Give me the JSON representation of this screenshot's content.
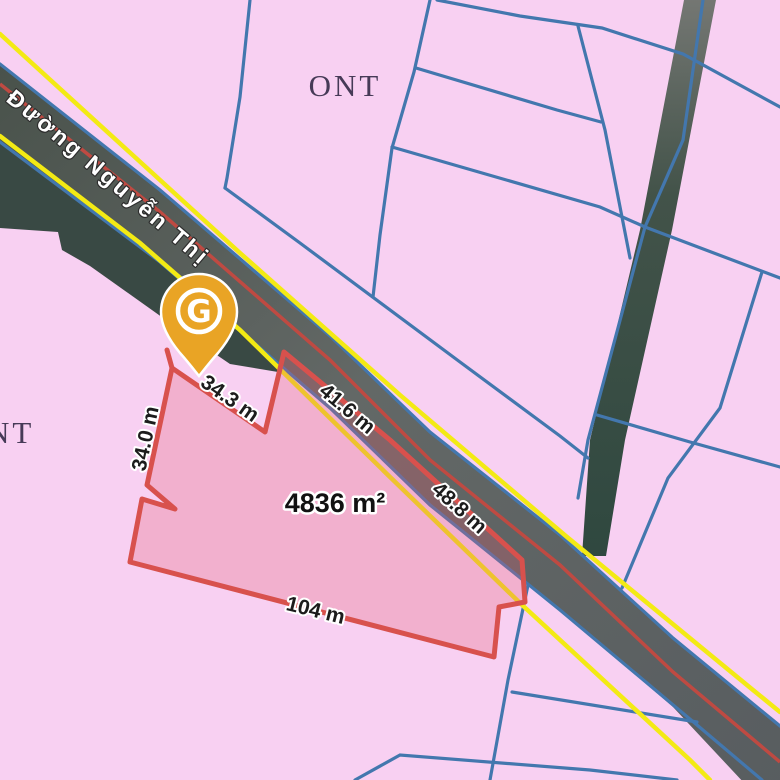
{
  "map": {
    "zone_labels": [
      {
        "text": "ONT"
      },
      {
        "text": "ONT"
      }
    ],
    "road": {
      "name": "Đường Nguyễn Thị"
    },
    "parcel": {
      "area_label": "4836 m²",
      "measurements": {
        "top": "34.3 m",
        "road_upper": "41.6 m",
        "road_lower": "48.8 m",
        "bottom": "104 m",
        "left": "34.0 m"
      }
    },
    "pin": {
      "letter": "G"
    },
    "colors": {
      "background_pink": "#f8d0f2",
      "parcel_line_blue": "#4377ae",
      "selected_parcel_red": "#d8514d",
      "road_marking_yellow": "#f3ea14",
      "road_axis_red": "#bf4a42",
      "pin_amber": "#e9a425"
    }
  }
}
